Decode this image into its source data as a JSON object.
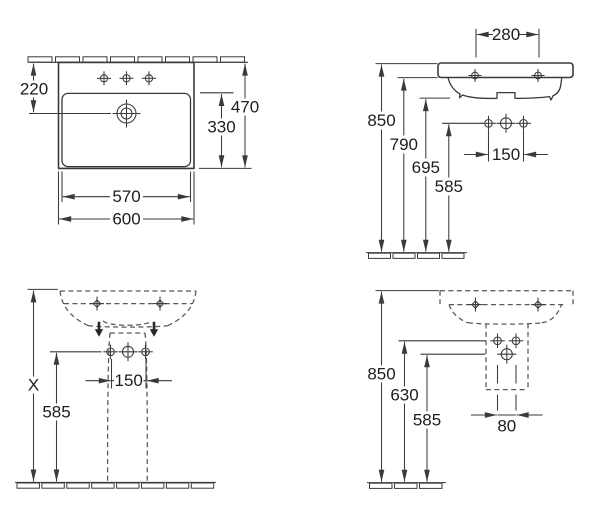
{
  "drawing": {
    "kind": "washbasin-with-pedestal-dimension-drawing",
    "background_color": "#ffffff",
    "line_color": "#3a3a3a",
    "views": {
      "plan": {
        "dims": {
          "wall_to_drain": "220",
          "overall_depth": "470",
          "bowl_depth": "330",
          "bowl_width": "570",
          "overall_width": "600"
        }
      },
      "side": {
        "dims": {
          "tap_hole_spacing": "280",
          "rim_height": "850",
          "apron_height": "790",
          "bowl_underside_height": "695",
          "fixing_hole_height": "585",
          "fixing_hole_spacing": "150"
        }
      },
      "front_pedestal": {
        "dims": {
          "height_x": "X",
          "fixing_hole_height": "585",
          "fixing_hole_spacing": "150"
        }
      },
      "side_pedestal": {
        "dims": {
          "rim_height": "850",
          "upper_fixing_height": "630",
          "lower_fixing_height": "585",
          "outlet_hole_spacing": "80"
        }
      }
    }
  }
}
